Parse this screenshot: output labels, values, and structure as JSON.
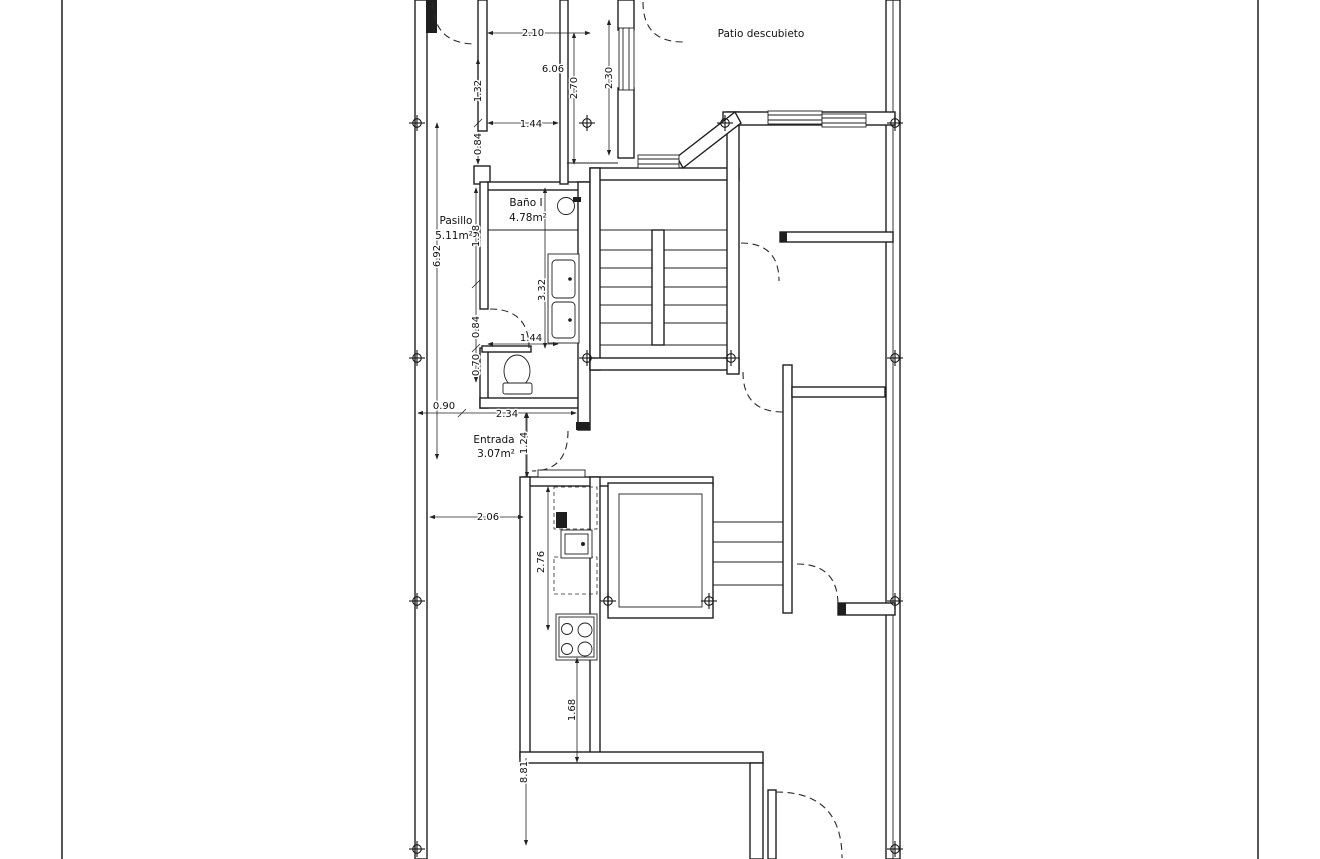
{
  "page": {
    "background": "#ffffff",
    "line_color": "#1f1f1f",
    "dim_text_color": "#101010"
  },
  "rooms": {
    "pasillo": {
      "name": "Pasillo",
      "area": "5.11m²"
    },
    "bano": {
      "name": "Baño I",
      "area": "4.78m²"
    },
    "entrada": {
      "name": "Entrada",
      "area": "3.07m²"
    },
    "patio": {
      "name": "Patio descubieto"
    },
    "upper_room": {
      "area": "6.06"
    }
  },
  "dims": {
    "w210": "2.10",
    "v270": "2.70",
    "v230": "2.30",
    "v132": "1.32",
    "v084a": "0.84",
    "w144a": "1.44",
    "v198": "1.98",
    "v332": "3.32",
    "v084b": "0.84",
    "w144b": "1.44",
    "v070": "0.70",
    "v692": "6.92",
    "w090": "0.90",
    "w234": "2.34",
    "v124": "1.24",
    "w206": "2.06",
    "v276": "2.76",
    "v168": "1.68",
    "v881": "8.81"
  }
}
